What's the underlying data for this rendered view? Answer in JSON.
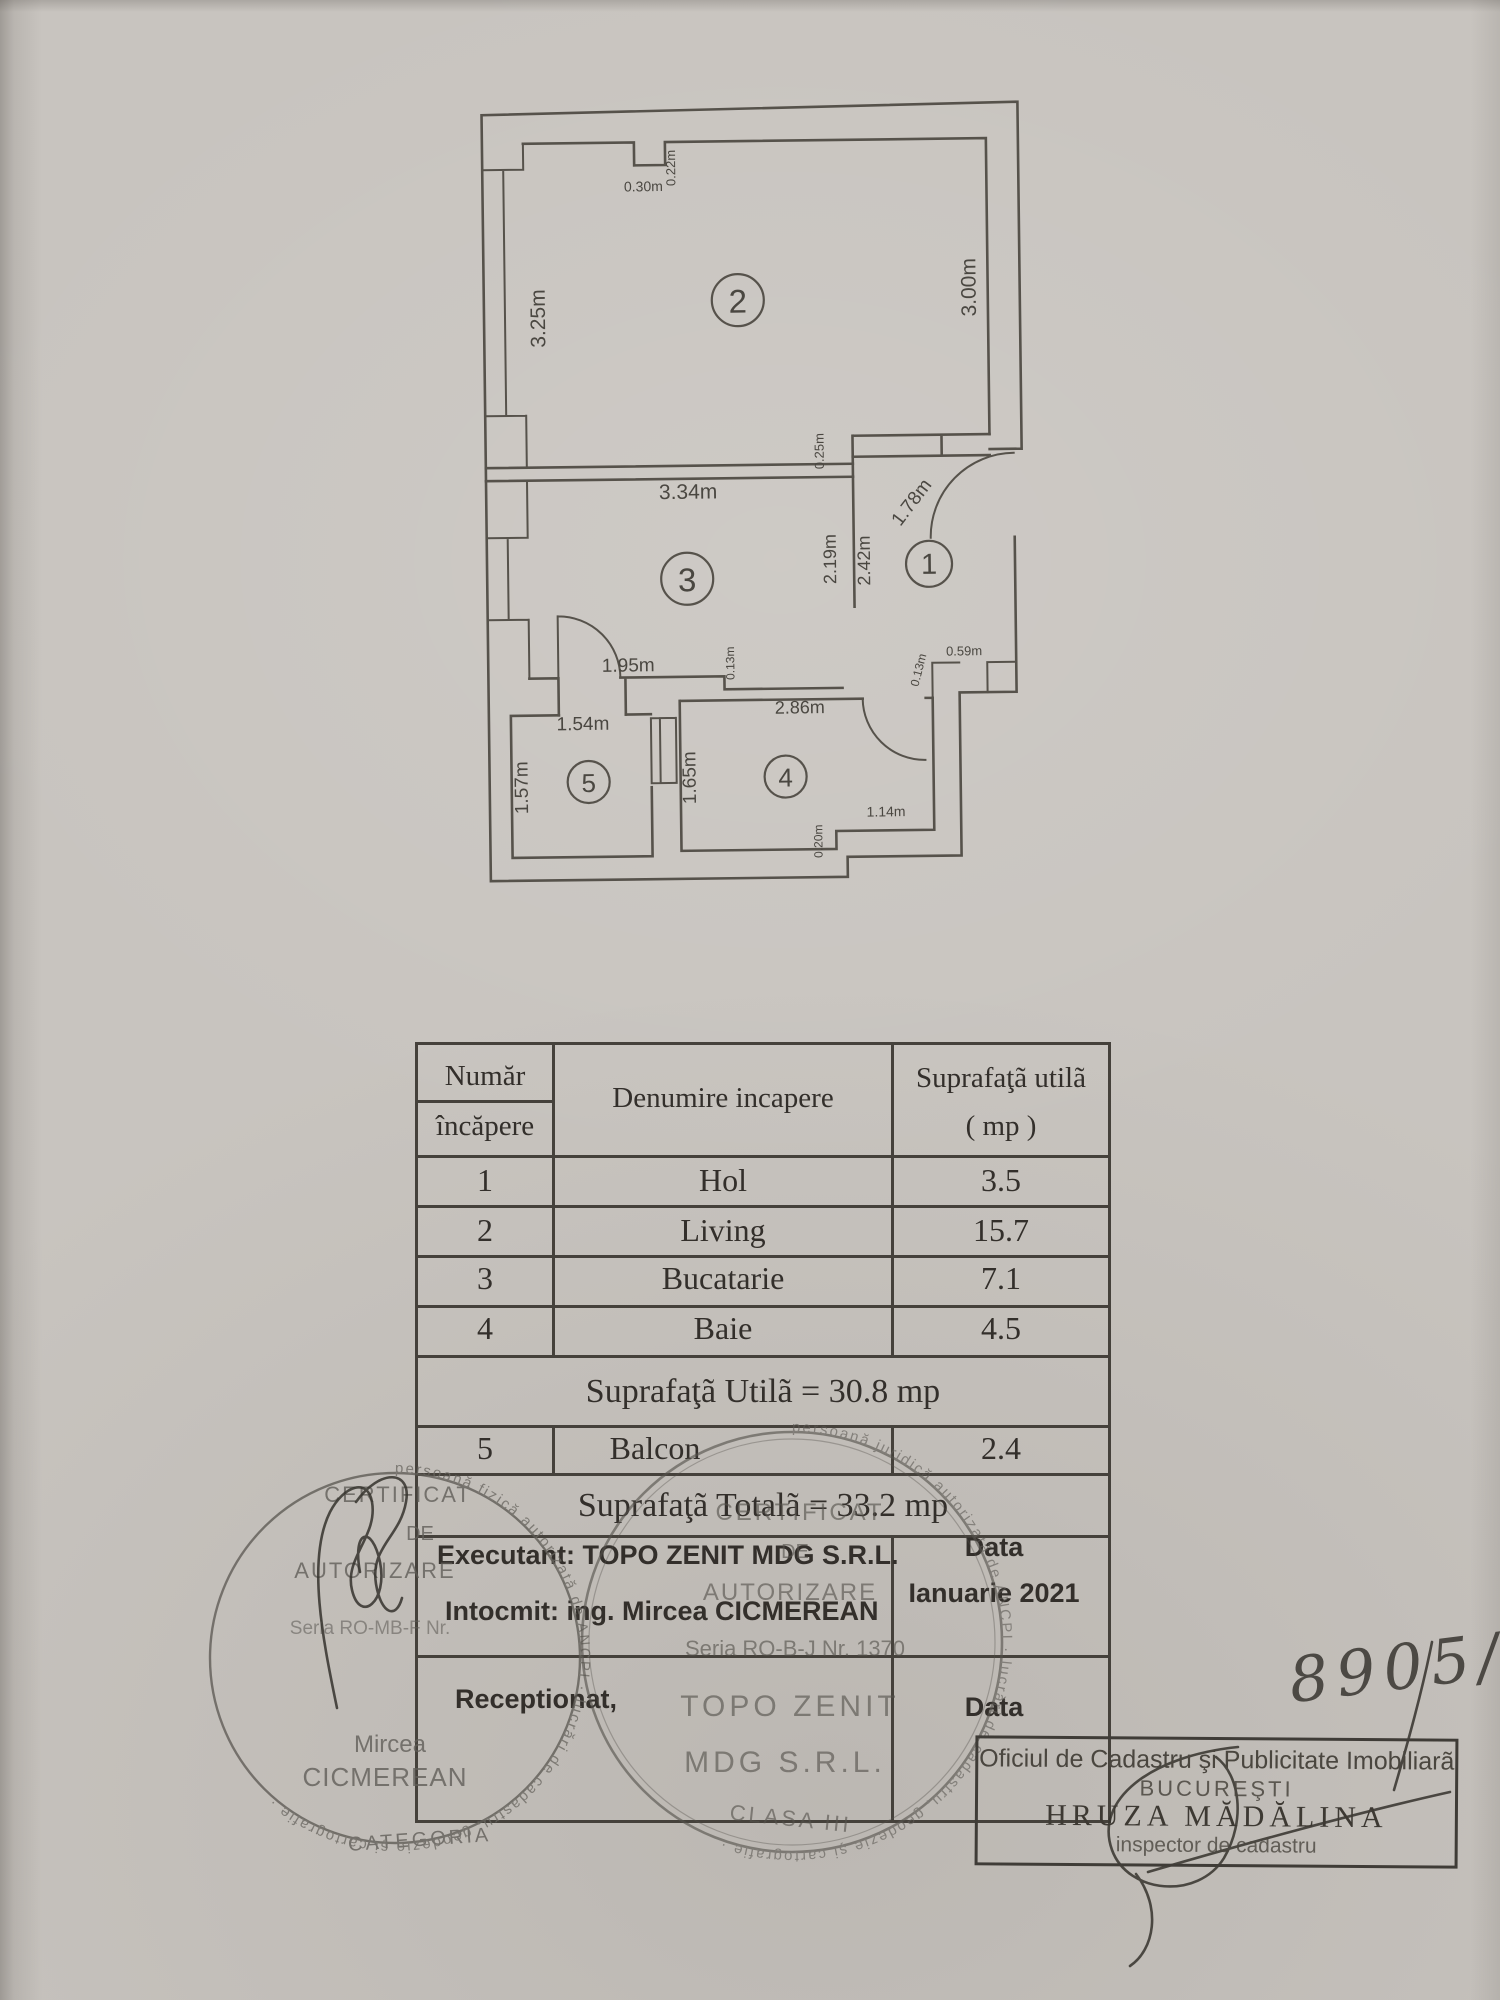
{
  "floor_plan": {
    "dimension_labels": [
      {
        "t": "0.30m",
        "x": 647,
        "y": 190,
        "r": 0,
        "s": 14
      },
      {
        "t": "0.22m",
        "x": 679,
        "y": 167,
        "r": -90,
        "s": 13
      },
      {
        "t": "3.25m",
        "x": 547,
        "y": 316,
        "r": -90,
        "s": 21
      },
      {
        "t": "3.00m",
        "x": 978,
        "y": 290,
        "r": -90,
        "s": 21
      },
      {
        "t": "3.34m",
        "x": 688,
        "y": 498,
        "r": 0,
        "s": 21
      },
      {
        "t": "0.25m",
        "x": 824,
        "y": 452,
        "r": -90,
        "s": 13
      },
      {
        "t": "1.78m",
        "x": 916,
        "y": 508,
        "r": -52,
        "s": 19
      },
      {
        "t": "2.19m",
        "x": 835,
        "y": 560,
        "r": -90,
        "s": 18
      },
      {
        "t": "2.42m",
        "x": 869,
        "y": 562,
        "r": -90,
        "s": 18
      },
      {
        "t": "1.95m",
        "x": 626,
        "y": 670,
        "r": 0,
        "s": 19
      },
      {
        "t": "0.13m",
        "x": 732,
        "y": 663,
        "r": -90,
        "s": 12
      },
      {
        "t": "0.59m",
        "x": 962,
        "y": 658,
        "r": 0,
        "s": 13
      },
      {
        "t": "0.13m",
        "x": 920,
        "y": 673,
        "r": -75,
        "s": 12
      },
      {
        "t": "1.54m",
        "x": 580,
        "y": 728,
        "r": 0,
        "s": 19
      },
      {
        "t": "1.57m",
        "x": 524,
        "y": 785,
        "r": -90,
        "s": 19
      },
      {
        "t": "1.65m",
        "x": 692,
        "y": 777,
        "r": -90,
        "s": 19
      },
      {
        "t": "2.86m",
        "x": 797,
        "y": 714,
        "r": 0,
        "s": 18
      },
      {
        "t": "1.14m",
        "x": 882,
        "y": 818,
        "r": 0,
        "s": 14
      },
      {
        "t": "0.20m",
        "x": 818,
        "y": 842,
        "r": -90,
        "s": 12
      }
    ],
    "room_numbers": [
      {
        "n": "2",
        "x": 740,
        "y": 300,
        "cr": 26
      },
      {
        "n": "1",
        "x": 928,
        "y": 566,
        "cr": 23
      },
      {
        "n": "3",
        "x": 686,
        "y": 578,
        "cr": 26
      },
      {
        "n": "5",
        "x": 585,
        "y": 780,
        "cr": 21
      },
      {
        "n": "4",
        "x": 782,
        "y": 777,
        "cr": 21
      }
    ]
  },
  "table": {
    "header": {
      "col1_line1": "Număr",
      "col1_line2": "încăpere",
      "col2": "Denumire incapere",
      "col3_line1": "Suprafaţã utilã",
      "col3_line2": "( mp )"
    },
    "rows": [
      {
        "num": "1",
        "name": "Hol",
        "area": "3.5"
      },
      {
        "num": "2",
        "name": "Living",
        "area": "15.7"
      },
      {
        "num": "3",
        "name": "Bucatarie",
        "area": "7.1"
      },
      {
        "num": "4",
        "name": "Baie",
        "area": "4.5"
      }
    ],
    "subtotal": "Suprafaţã Utilã = 30.8 mp",
    "balcony_row": {
      "num": "5",
      "name": "Balcon",
      "area": "2.4"
    },
    "total": "Suprafaţã Totalã = 33.2 mp"
  },
  "signing": {
    "executant": "Executant: TOPO ZENIT MDG S.R.L.",
    "intocmit": "Intocmit: ing. Mircea CICMEREAN",
    "data_label_top": "Data",
    "data_value": "Ianuarie 2021",
    "receptionat": "Receptionat,",
    "data_label_bottom": "Data"
  },
  "stamps": {
    "left": {
      "l1": "CERTIFICAT",
      "l2": "DE",
      "l3": "AUTORIZARE",
      "l4": "Seria RO-MB-F Nr.",
      "l5": "Mircea",
      "l6": "CICMEREAN",
      "l7": "CATEGORIA",
      "ring": "persoană fizică autorizată de ANCPI · lucrări de cadastru, geodezie şi cartografie · "
    },
    "right": {
      "l1": "CERTIFICAT",
      "l2": "DE",
      "l3": "AUTORIZARE",
      "l4": "Seria RO-B-J Nr. 1370",
      "l5": "TOPO ZENIT",
      "l6": "MDG S.R.L.",
      "l7": "CLASA III",
      "ring": "persoană juridică autorizată de ANCPI · lucrări de cadastru, geodezie şi cartografie · "
    },
    "office": {
      "line1": "Oficiul de Cadastru şi Publicitate Imobiliarã",
      "line2": "BUCUREŞTI",
      "line3": "HRUZA MĂDĂLINA",
      "line4": "inspector de cadastru"
    }
  },
  "handwriting": {
    "number": "8905/20"
  }
}
